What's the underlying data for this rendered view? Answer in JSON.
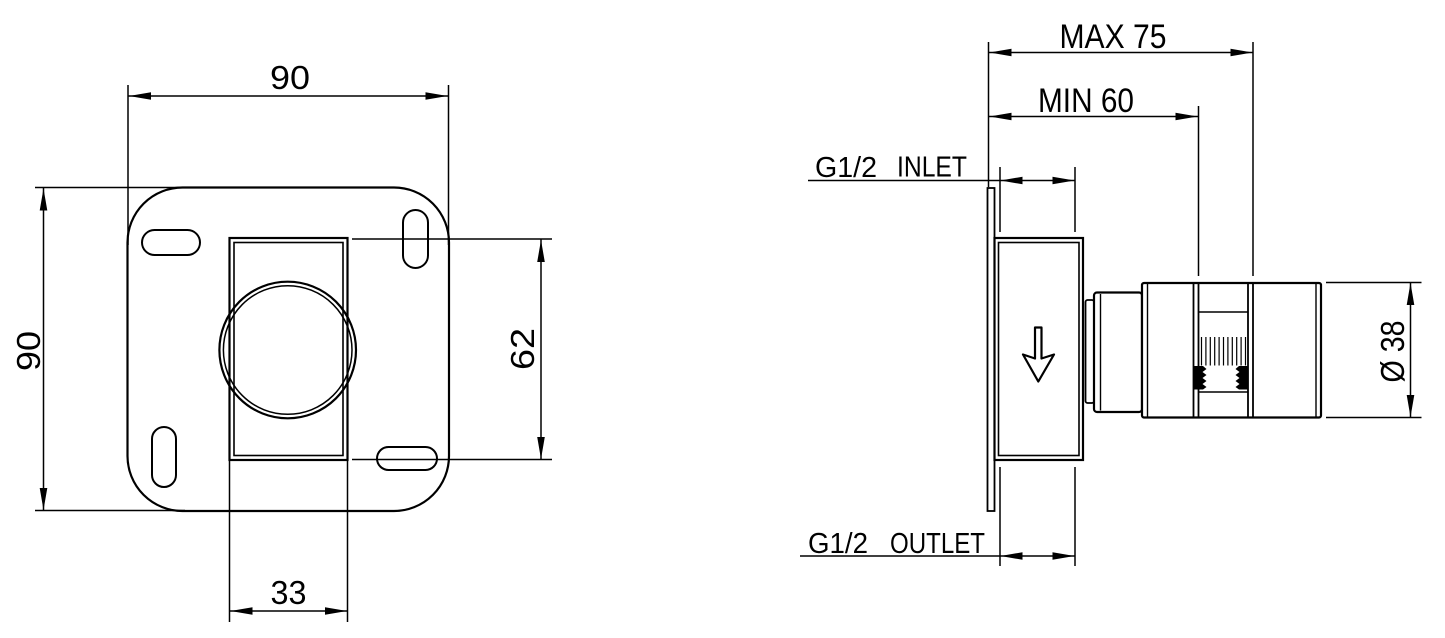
{
  "colors": {
    "line": "#000000",
    "background": "#ffffff"
  },
  "front_view": {
    "width_label": "90",
    "height_label": "90",
    "cutout_height_label": "62",
    "cutout_width_label": "33"
  },
  "side_view": {
    "max_depth_label": "MAX 75",
    "min_depth_label": "MIN 60",
    "inlet_thread": "G1/2",
    "inlet_label": "INLET",
    "outlet_thread": "G1/2",
    "outlet_label": "OUTLET",
    "diameter_label": "Ø 38",
    "flow_icon": "arrow-down"
  }
}
